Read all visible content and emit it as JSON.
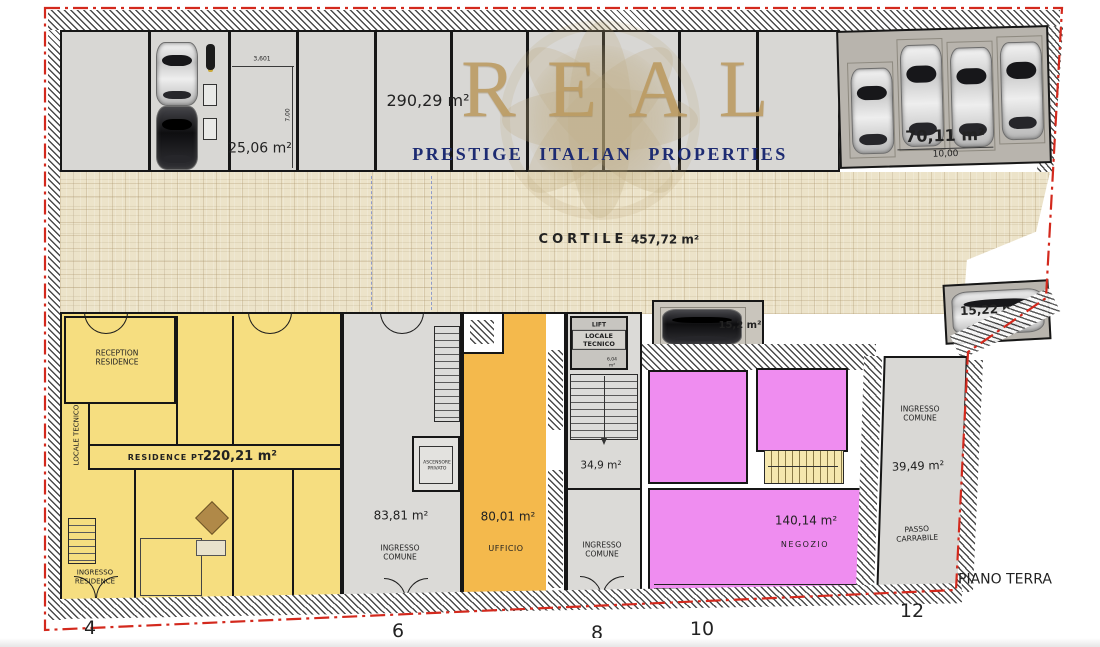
{
  "watermark": {
    "brand": "REAL",
    "tagline": "PRESTIGE ITALIAN PROPERTIES"
  },
  "plan": {
    "label": "PIANO TERRA",
    "street_numbers": [
      "4",
      "6",
      "8",
      "10",
      "12"
    ]
  },
  "garage": {
    "stall_area": "25,06 m²",
    "stall_width": "3,601",
    "stall_depth": "7,00",
    "hall_area": "290,29 m²",
    "carport_area": "70,11 m²",
    "carport_width": "10,00"
  },
  "cortile": {
    "name": "CORTILE",
    "area": "457,72 m²"
  },
  "parking": {
    "spot_a": "15,2 m²",
    "spot_b": "15,22 m²"
  },
  "residence": {
    "reception": "RECEPTION RESIDENCE",
    "locale_tecnico": "LOCALE TECNICO",
    "name": "RESIDENCE PT",
    "area": "220,21 m²",
    "entrance": "INGRESSO RESIDENCE"
  },
  "common1": {
    "area": "83,81 m²",
    "name": "INGRESSO COMUNE",
    "lift": "ASCENSORE PRIVATO"
  },
  "office": {
    "area": "80,01 m²",
    "name": "UFFICIO"
  },
  "techblock": {
    "lift": "LIFT",
    "name": "LOCALE TECNICO",
    "area": "6,04 m²"
  },
  "stairblock": {
    "area": "34,9 m²"
  },
  "common2": {
    "name": "INGRESSO COMUNE"
  },
  "shop": {
    "area": "140,14 m²",
    "name": "NEEGOZIO_PLACEHOLDER"
  },
  "common3": {
    "name": "INGRESSO COMUNE",
    "area": "39,49 m²",
    "passage": "PASSO CARRABILE"
  },
  "colors": {
    "residence_yellow": "#f6de80",
    "office_orange": "#f4b94c",
    "shop_pink": "#ef8df0",
    "garage_gray": "#d8d7d4",
    "carport_gray": "#b8b4ad",
    "cortile_beige": "#ece3c9",
    "border_red": "#d3291d",
    "brand_gold": "#bb9a60",
    "tagline_navy": "#1d2b72"
  }
}
